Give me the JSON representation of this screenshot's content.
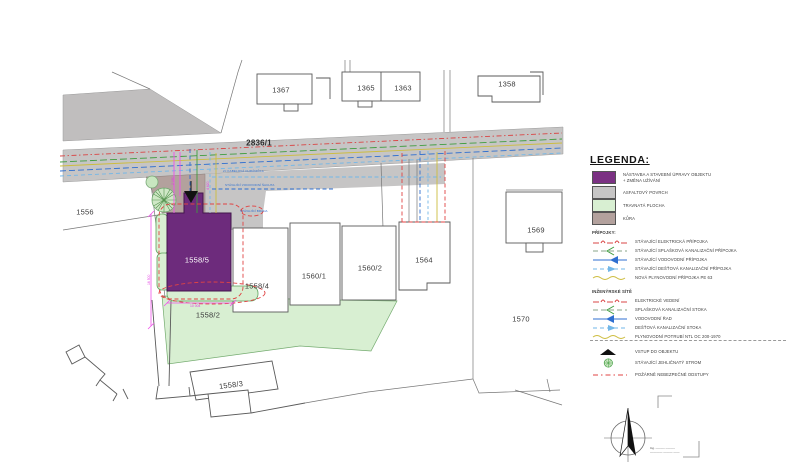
{
  "drawing": {
    "road_label": "2836/1",
    "parcels": [
      {
        "label": "1367"
      },
      {
        "label": "1365"
      },
      {
        "label": "1363"
      },
      {
        "label": "1358"
      },
      {
        "label": "1556"
      },
      {
        "label": "1569"
      },
      {
        "label": "1570"
      },
      {
        "label": "1558/5"
      },
      {
        "label": "1558/4"
      },
      {
        "label": "1560/1"
      },
      {
        "label": "1560/2"
      },
      {
        "label": "1564"
      },
      {
        "label": "1558/2"
      },
      {
        "label": "1558/3"
      }
    ],
    "annotations": {
      "blue_1": "2× KABELOVÁ CHRÁNIČKA",
      "blue_2": "STÁVAJÍCÍ VODOVODNÍ ŠACHTA",
      "blue_3": "STÁVAJÍCÍ BRÁNA",
      "dim_vertical": "16 500",
      "dim_horizontal": "10 004",
      "dim_small_1": "2 050",
      "dim_small_2": "4 620"
    }
  },
  "legend": {
    "title": "LEGENDA:",
    "areas": [
      {
        "label": "NÁSTAVBA A STAVEBNÍ ÚPRAVY OBJEKTU",
        "label2": "+ ZMĚNA UŽÍVÁNÍ",
        "color": "#7b3183"
      },
      {
        "label": "ASFALTOVÝ POVRCH",
        "color": "#c6c5c5"
      },
      {
        "label": "TRAVNATÁ PLOCHA",
        "color": "#d8efd2"
      },
      {
        "label": "KŮRA",
        "color": "#b3a19d"
      }
    ],
    "section_connections": {
      "title": "PŘÍPOJKY:",
      "items": [
        "STÁVAJÍCÍ ELEKTRICKÁ PŘÍPOJKA",
        "STÁVAJÍCÍ SPLAŠKOVÁ KANALIZAČNÍ PŘÍPOJKA",
        "STÁVAJÍCÍ VODOVODNÍ PŘÍPOJKA",
        "STÁVAJÍCÍ DEŠŤOVÁ KANALIZAČNÍ PŘÍPOJKA",
        "NOVÁ PLYNOVODNÍ PŘÍPOJKA PE 63"
      ]
    },
    "section_networks": {
      "title": "INŽENÝRSKÉ SÍTĚ",
      "items": [
        "ELEKTRICKÉ VEDENÍ",
        "SPLAŠKOVÁ KANALIZAČNÍ STOKA",
        "VODOVODNÍ ŘAD",
        "DEŠŤOVÁ KANALIZAČNÍ STOKA",
        "PLYNOVODNÍ POTRUBÍ NTL OC 200-1970"
      ]
    },
    "symbols": [
      "VSTUP DO OBJEKTU",
      "STÁVAJÍCÍ JEHLIČNATÝ STROM",
      "POŽÁRNĚ NEBEZPEČNÉ ODSTUPY"
    ]
  },
  "footer": {
    "fine_print_line1": "Ing. –––––– ––––––",
    "fine_print_line2": "–––––––– –––––– ––––"
  },
  "colors": {
    "building_new": "#7b3183",
    "asphalt": "#c6c5c5",
    "grass": "#d8efd2",
    "bark": "#b3a19d",
    "electric": "#d94545",
    "sewage": "#3f9d3f",
    "water": "#2f6fd0",
    "rain": "#72b7e8",
    "gas": "#cdbd3e",
    "fire_safety": "#e04343",
    "dimension": "#ef52ea"
  }
}
